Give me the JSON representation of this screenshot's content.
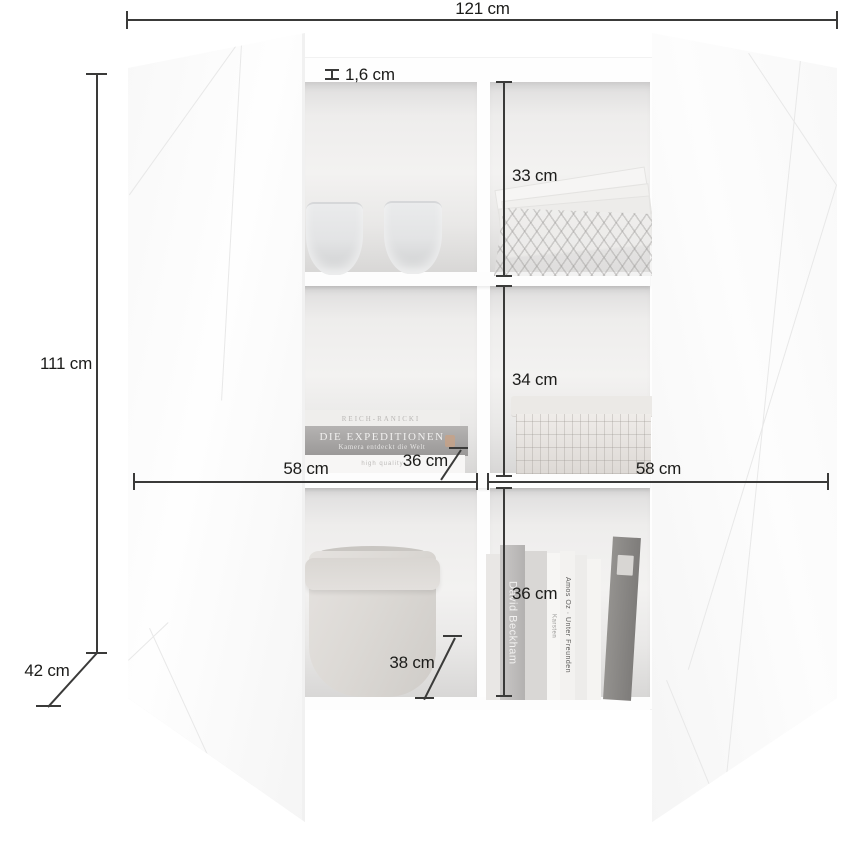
{
  "dimensions": {
    "total_width": "121 cm",
    "total_height": "111 cm",
    "total_depth": "42 cm",
    "panel_thickness": "1,6 cm",
    "compartment_top_height": "33 cm",
    "compartment_middle_height": "34 cm",
    "compartment_bottom_height": "36 cm",
    "compartment_left_width": "58 cm",
    "compartment_right_width": "58 cm",
    "shelf_depth": "36 cm",
    "bottom_shelf_depth": "38 cm"
  },
  "decor": {
    "flat_books": {
      "top": "REICH-RANICKI",
      "middle_title": "DIE EXPEDITIONEN",
      "middle_subtitle": "Kamera entdeckt die Welt",
      "base": "high quality"
    },
    "standing_books": {
      "b1": "David Beckham",
      "b3": "Karsten",
      "b4": "Amos Oz · Unter Freunden"
    }
  },
  "colors": {
    "dimension_line": "#3a3a39",
    "interior_gray": "#e9e8e7",
    "door_white": "#fbfbfb"
  }
}
